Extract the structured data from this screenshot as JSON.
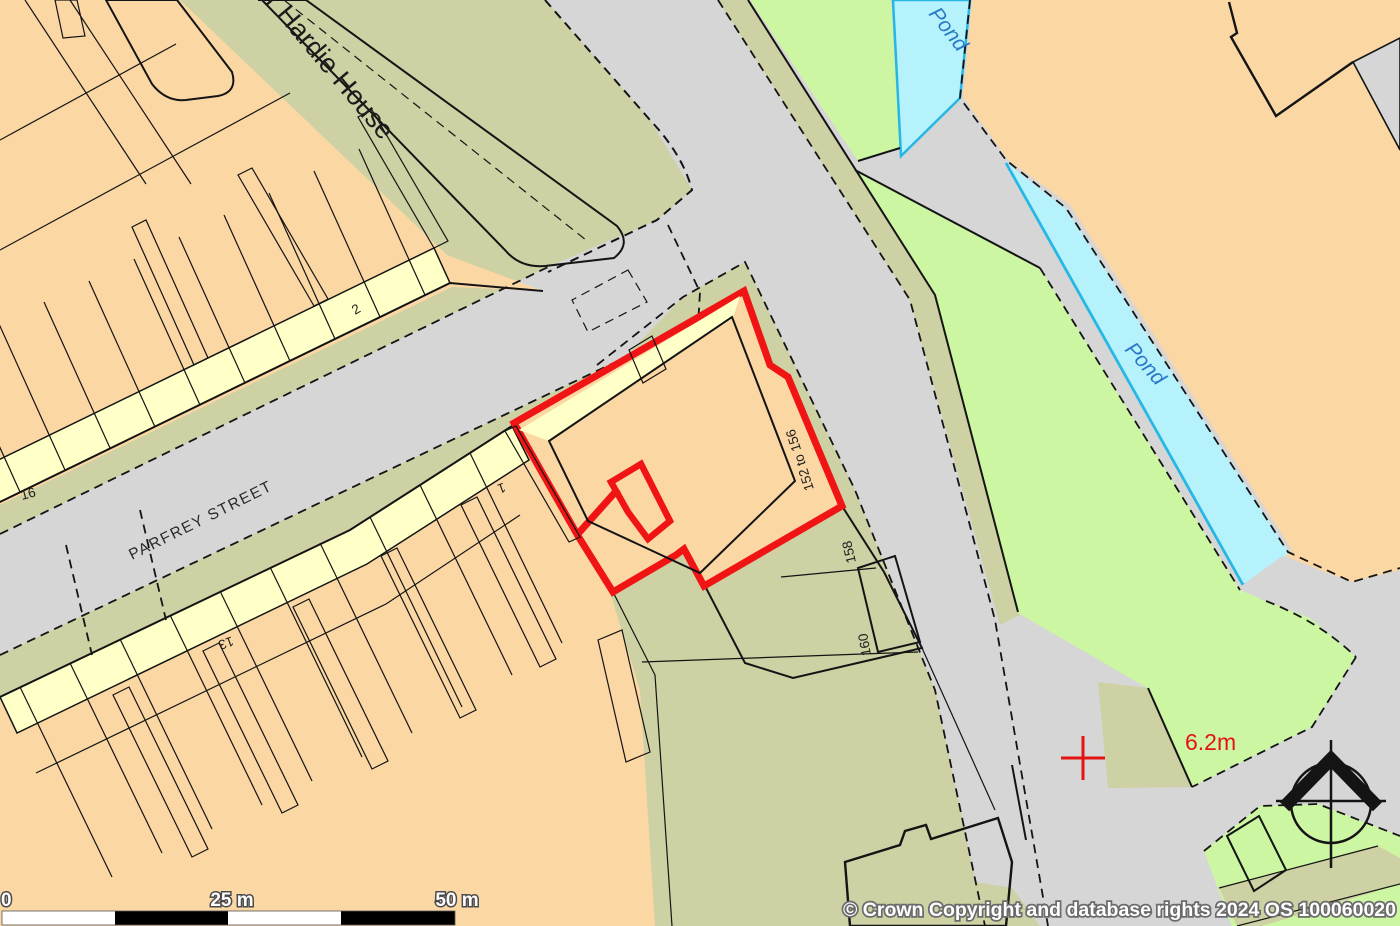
{
  "map": {
    "street_label": "PARFREY STREET",
    "building_labels": {
      "hardie_house": "r Hardie House",
      "site_range": "152 to 156",
      "no_158": "158",
      "no_160": "160",
      "no_2": "2",
      "no_16": "16",
      "no_13": "13",
      "no_1": "1"
    },
    "water_labels": {
      "pond_top": "Pond",
      "pond_long": "Pond"
    },
    "spot_height": "6.2m",
    "scale_bar": {
      "start": "0",
      "mid": "25 m",
      "end": "50 m"
    },
    "copyright": "© Crown Copyright and database rights 2024 OS 100060020",
    "colors": {
      "building_primary": "#fbd7a4",
      "building_secondary": "#ffffc8",
      "land": "#cdd1a3",
      "road": "#d6d6d6",
      "grass": "#ccf6a2",
      "water_fill": "#b6f2fb",
      "water_edge": "#27b7e5",
      "water_text": "#2878c8",
      "site_outline": "#f01414",
      "spot_height_text": "#e41414",
      "line": "#141414"
    }
  }
}
